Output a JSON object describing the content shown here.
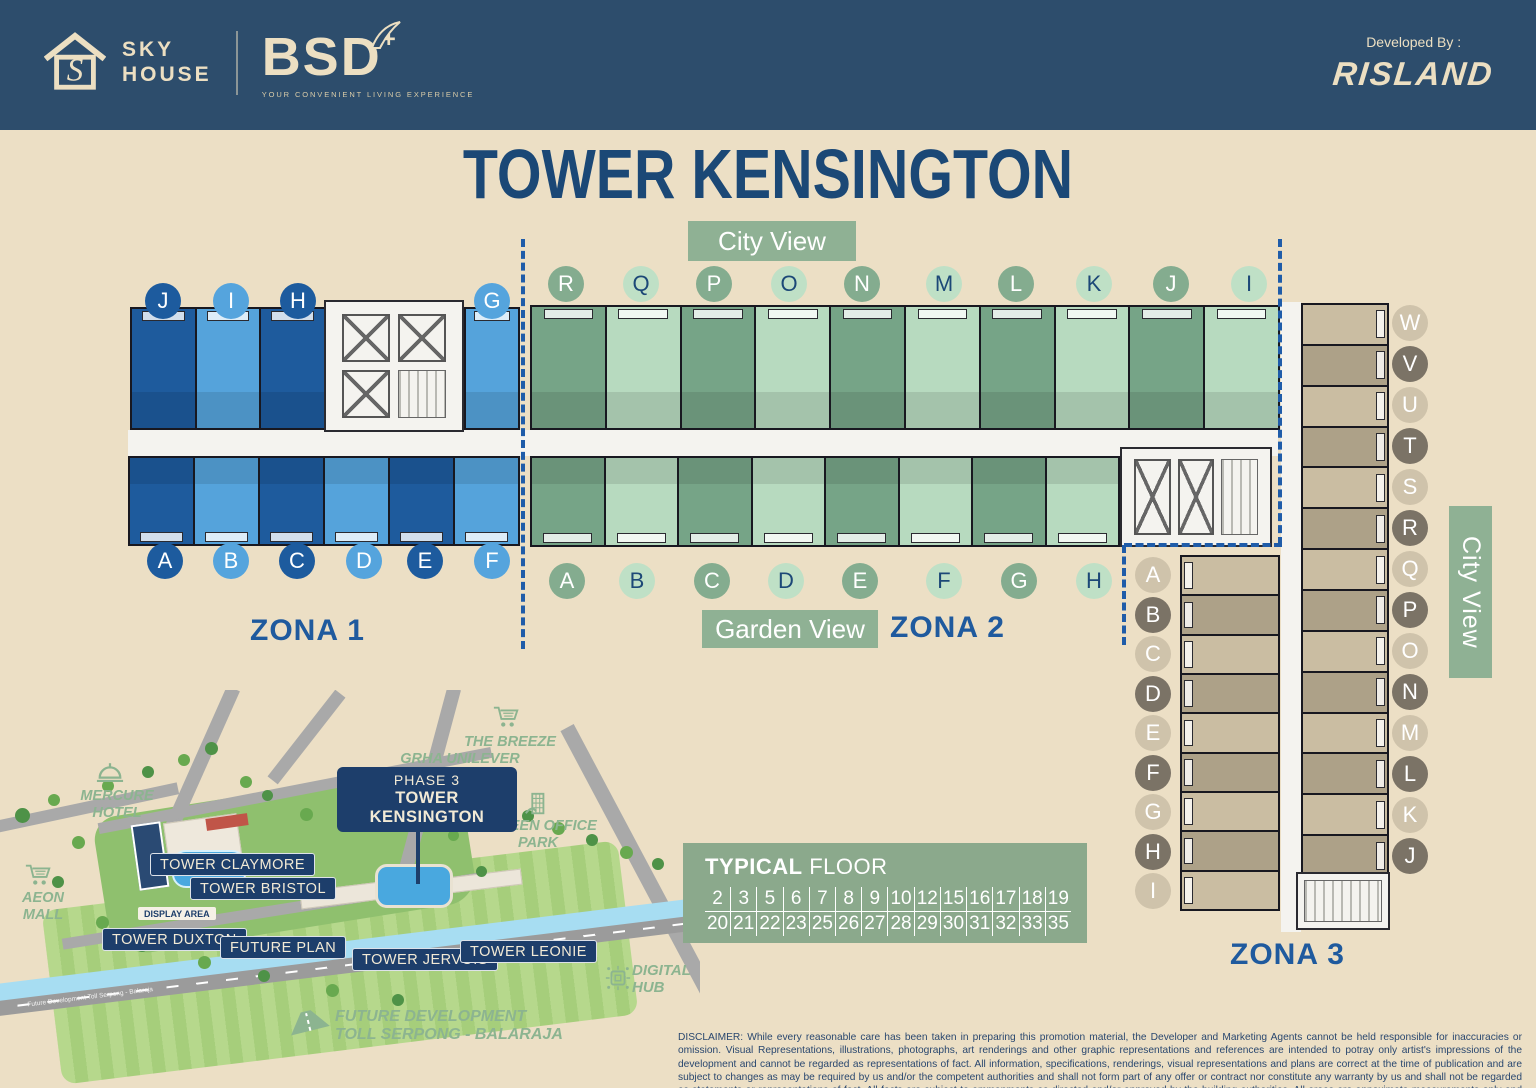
{
  "header": {
    "brand_sky": "SKY",
    "brand_house": "HOUSE",
    "brand_bsd": "BSD",
    "brand_plus": "+",
    "tagline": "YOUR CONVENIENT LIVING EXPERIENCE",
    "developed_by": "Developed By :",
    "developer": "RISLAND"
  },
  "title": "TOWER KENSINGTON",
  "labels": {
    "city_view_top": "City View",
    "city_view_right": "City View",
    "garden_view": "Garden View",
    "zona1": "ZONA 1",
    "zona2": "ZONA 2",
    "zona3": "ZONA 3"
  },
  "zona1": {
    "top_letters": [
      {
        "label": "J",
        "variant": "dark"
      },
      {
        "label": "I",
        "variant": "light"
      },
      {
        "label": "H",
        "variant": "dark"
      },
      {
        "label": "G",
        "variant": "light"
      }
    ],
    "bottom_letters": [
      {
        "label": "A",
        "variant": "dark"
      },
      {
        "label": "B",
        "variant": "light"
      },
      {
        "label": "C",
        "variant": "dark"
      },
      {
        "label": "D",
        "variant": "light"
      },
      {
        "label": "E",
        "variant": "dark"
      },
      {
        "label": "F",
        "variant": "light"
      }
    ]
  },
  "zona2": {
    "top_letters": [
      {
        "label": "R",
        "variant": "dark"
      },
      {
        "label": "Q",
        "variant": "light"
      },
      {
        "label": "P",
        "variant": "dark"
      },
      {
        "label": "O",
        "variant": "light"
      },
      {
        "label": "N",
        "variant": "dark"
      },
      {
        "label": "M",
        "variant": "light"
      },
      {
        "label": "L",
        "variant": "dark"
      },
      {
        "label": "K",
        "variant": "light"
      },
      {
        "label": "J",
        "variant": "dark"
      },
      {
        "label": "I",
        "variant": "light"
      }
    ],
    "bottom_letters": [
      {
        "label": "A",
        "variant": "dark"
      },
      {
        "label": "B",
        "variant": "light"
      },
      {
        "label": "C",
        "variant": "dark"
      },
      {
        "label": "D",
        "variant": "light"
      },
      {
        "label": "E",
        "variant": "dark"
      },
      {
        "label": "F",
        "variant": "light"
      },
      {
        "label": "G",
        "variant": "dark"
      },
      {
        "label": "H",
        "variant": "light"
      }
    ]
  },
  "zona3": {
    "right_letters": [
      {
        "label": "W",
        "variant": "light"
      },
      {
        "label": "V",
        "variant": "dark"
      },
      {
        "label": "U",
        "variant": "light"
      },
      {
        "label": "T",
        "variant": "dark"
      },
      {
        "label": "S",
        "variant": "light"
      },
      {
        "label": "R",
        "variant": "dark"
      },
      {
        "label": "Q",
        "variant": "light"
      },
      {
        "label": "P",
        "variant": "dark"
      },
      {
        "label": "O",
        "variant": "light"
      },
      {
        "label": "N",
        "variant": "dark"
      },
      {
        "label": "M",
        "variant": "light"
      },
      {
        "label": "L",
        "variant": "dark"
      },
      {
        "label": "K",
        "variant": "light"
      },
      {
        "label": "J",
        "variant": "dark"
      }
    ],
    "left_letters": [
      {
        "label": "A",
        "variant": "light"
      },
      {
        "label": "B",
        "variant": "dark"
      },
      {
        "label": "C",
        "variant": "light"
      },
      {
        "label": "D",
        "variant": "dark"
      },
      {
        "label": "E",
        "variant": "light"
      },
      {
        "label": "F",
        "variant": "dark"
      },
      {
        "label": "G",
        "variant": "light"
      },
      {
        "label": "H",
        "variant": "dark"
      },
      {
        "label": "I",
        "variant": "light"
      }
    ]
  },
  "typical_floor": {
    "heading_bold": "TYPICAL",
    "heading_rest": " FLOOR",
    "rows": [
      [
        "2",
        "3",
        "5",
        "6",
        "7",
        "8",
        "9",
        "10",
        "12",
        "15",
        "16",
        "17",
        "18",
        "19"
      ],
      [
        "20",
        "21",
        "22",
        "23",
        "25",
        "26",
        "27",
        "28",
        "29",
        "30",
        "31",
        "32",
        "33",
        "35"
      ]
    ]
  },
  "map": {
    "mercure_line1": "MERCURE",
    "mercure_line2": "HOTEL",
    "aeon_line1": "AEON",
    "aeon_line2": "MALL",
    "breeze": "THE BREEZE",
    "grha": "GRHA UNILEVER",
    "phase": "PHASE 3",
    "kensington": "TOWER KENSINGTON",
    "green_office_line1": "GREEN OFFICE",
    "green_office_line2": "PARK",
    "claymore": "TOWER CLAYMORE",
    "bristol": "TOWER BRISTOL",
    "duxton": "TOWER DUXTON",
    "display_area": "DISPLAY AREA",
    "future_plan": "FUTURE PLAN",
    "jervois": "TOWER JERVOIS",
    "leonie": "TOWER LEONIE",
    "digital_line1": "DIGITAL",
    "digital_line2": "HUB",
    "future_dev_line1": "FUTURE DEVELOPMENT",
    "future_dev_line2": "TOLL SERPONG - BALARAJA",
    "toll_road_text": "Future Development Toll Serpong - Balaraja"
  },
  "colors": {
    "header_navy": "#2d4d6c",
    "cream": "#ecdfc2",
    "title_navy": "#1b4876",
    "zona_label_blue": "#1f5a9e",
    "sage": "#8fb194",
    "blue_dark": "#1e5b9d",
    "blue_light": "#55a3db",
    "green_dark": "#76a487",
    "green_light": "#b7dabf",
    "tan_light": "#cabda2",
    "tan_dark": "#ada188",
    "map_navy": "#1d3e6b",
    "map_green_text": "#8cb490"
  },
  "disclaimer": "DISCLAIMER: While every reasonable care has been taken in preparing this promotion material, the Developer and Marketing Agents cannot be held responsible for inaccuracies or omission. Visual Representations, illustrations, photographs, art renderings and other graphic representations and references are intended to potray only artist's impressions of the development and cannot be regarded as representations of fact. All information, specifications, renderings, visual representations and plans are correct at the time of publication and are subject to changes as may be required by us and/or the competent authorities and shall not form part of any offer or contract nor constitute any warranty by us and shall not be regarded as statements or representations of fact. All facts are subject to ammanments as directed and/or approved by the building authorities. All areas are appoximate measurements only and subject to Final Survey. The Sale and Purchase Agreement shall form the entire agreement between us as the Developer and the Purchaser and shall supersede all statements, representations or promises made prior to the signing of the Sale & Purchase Agreement and shall in no way be modified by any statements, representations or promises made by us or the Marketing Agents."
}
